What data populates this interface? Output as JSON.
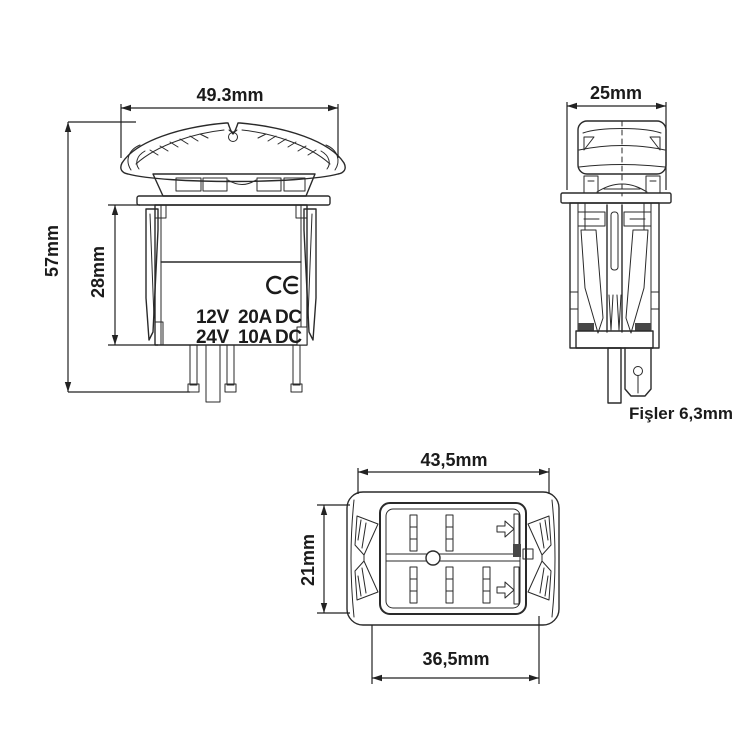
{
  "title": "Rocker switch technical drawing",
  "colors": {
    "background": "#ffffff",
    "line": "#2a2a2a",
    "text": "#1b1b1b"
  },
  "views": {
    "front": {
      "name": "front view",
      "width_label": "49.3mm",
      "total_height_label": "57mm",
      "body_height_label": "28mm",
      "ce_mark_icon": "ce-mark",
      "rating_rows": [
        [
          "12V",
          "20A",
          "DC"
        ],
        [
          "24V",
          "10A",
          "DC"
        ]
      ]
    },
    "side": {
      "name": "side view",
      "width_label": "25mm",
      "terminal_label": "Fişler 6,3mm"
    },
    "bottom": {
      "name": "bottom view",
      "outer_width_label": "43,5mm",
      "height_label": "21mm",
      "inner_width_label": "36,5mm"
    }
  }
}
